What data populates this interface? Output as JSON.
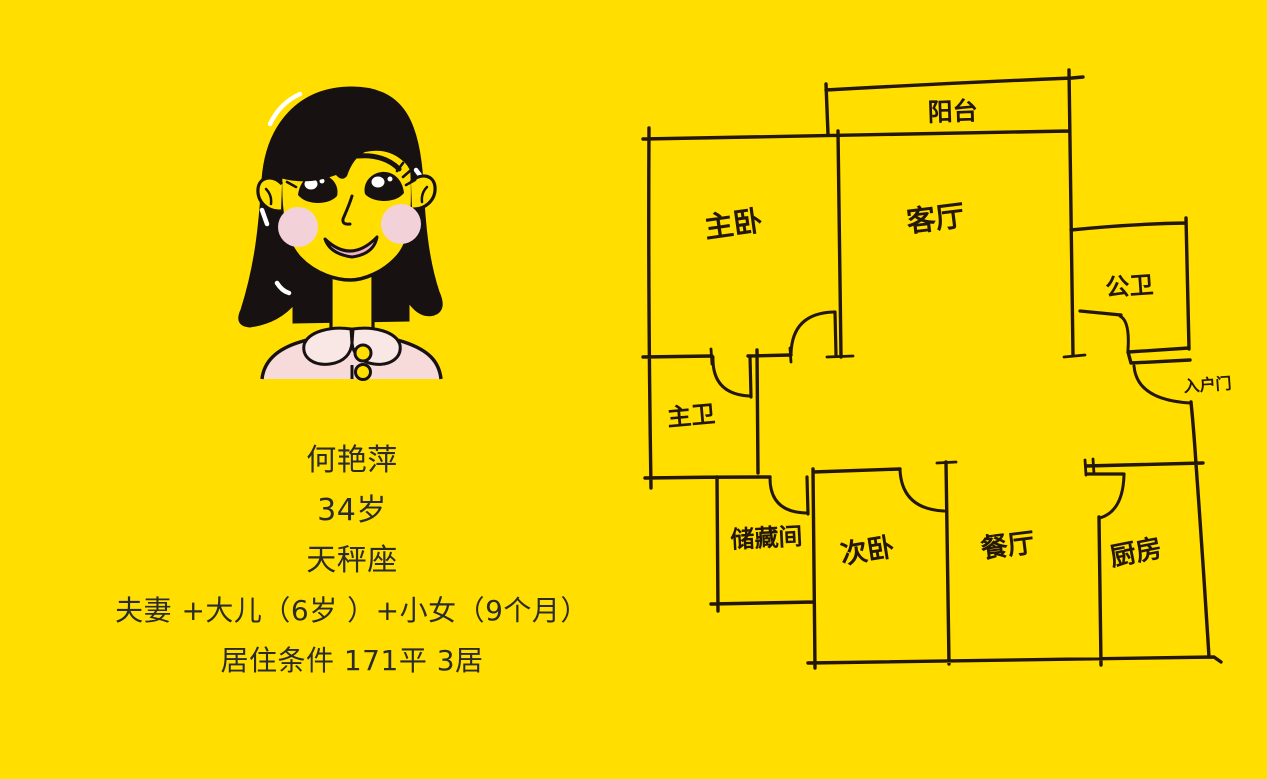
{
  "poster": {
    "background_color": "#FFDE00",
    "ink_color": "#241708",
    "text_color": "#2B2B2B"
  },
  "profile": {
    "name": "何艳萍",
    "age": "34岁",
    "zodiac": "天秤座",
    "family": "夫妻 +大儿（6岁 ）+小女（9个月）",
    "living_condition": "居住条件 171平 3居",
    "avatar": {
      "description": "cartoon-woman-bob-hair",
      "hair_color": "#171112",
      "skin_color": "#FFDE00",
      "shirt_color": "#F6DBDA",
      "collar_color": "#F9E7E5",
      "cheek_color": "#F2D2D8",
      "lip_color": "#EFB0C1"
    }
  },
  "floor_plan": {
    "style": "hand-drawn-sketch",
    "rooms": [
      {
        "label": "阳台"
      },
      {
        "label": "主卧"
      },
      {
        "label": "客厅"
      },
      {
        "label": "公卫"
      },
      {
        "label": "入户门"
      },
      {
        "label": "主卫"
      },
      {
        "label": "储藏间"
      },
      {
        "label": "次卧"
      },
      {
        "label": "餐厅"
      },
      {
        "label": "厨房"
      }
    ]
  }
}
